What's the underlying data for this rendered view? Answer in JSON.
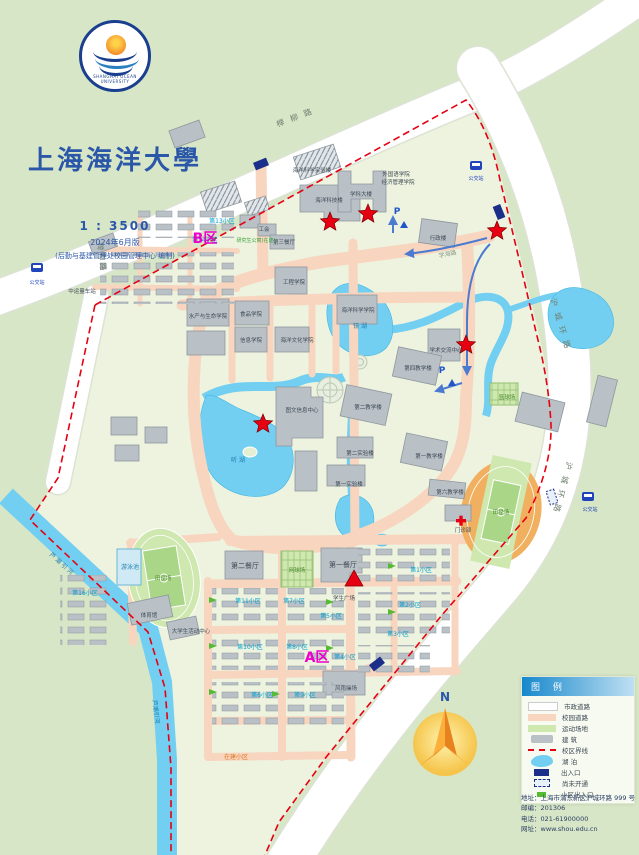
{
  "header": {
    "university_cn": "上海海洋大學",
    "university_en": "SHANGHAI OCEAN UNIVERSITY",
    "scale": "1 : 3500",
    "edition": "2024年6月版",
    "credit": "(后勤与基建管理处校园管理中心 编制)"
  },
  "compass": {
    "north": "N"
  },
  "legend": {
    "title": "图 例",
    "items": [
      {
        "label": "市政道路",
        "type": "road-city"
      },
      {
        "label": "校园道路",
        "type": "road-campus"
      },
      {
        "label": "运动场地",
        "type": "sports"
      },
      {
        "label": "建  筑",
        "type": "building"
      },
      {
        "label": "校区界线",
        "type": "boundary"
      },
      {
        "label": "湖  泊",
        "type": "lake"
      },
      {
        "label": "出入口",
        "type": "gate"
      },
      {
        "label": "尚未开通",
        "type": "gate-closed"
      },
      {
        "label": "小区出入口",
        "type": "community-gate"
      }
    ],
    "contact": [
      "地址：上海市浦东新区沪城环路 999 号",
      "邮编：201306",
      "电话：021-61900000",
      "网址：www.shou.edu.cn"
    ]
  },
  "map": {
    "labels": [
      {
        "text": "榉 柳 路",
        "x": 296,
        "y": 120,
        "rot": -21,
        "cls": "road"
      },
      {
        "text": "榉柳路",
        "x": 99,
        "y": 258,
        "rot": 82,
        "cls": "road"
      },
      {
        "text": "沪 城 环 路",
        "x": 558,
        "y": 325,
        "rot": 73,
        "cls": "road"
      },
      {
        "text": "沪 城 环 路",
        "x": 560,
        "y": 487,
        "rot": 105,
        "cls": "road"
      },
      {
        "text": "芦 潮 引 河",
        "x": 60,
        "y": 565,
        "rot": 42,
        "cls": "water"
      },
      {
        "text": "芦潮引河",
        "x": 154,
        "y": 712,
        "rot": 83,
        "cls": "water"
      },
      {
        "text": "镜 湖",
        "x": 360,
        "y": 328,
        "cls": "water"
      },
      {
        "text": "听 湖",
        "x": 238,
        "y": 462,
        "cls": "water"
      },
      {
        "text": "游泳池",
        "x": 130,
        "y": 569,
        "cls": "water"
      },
      {
        "text": "学海路",
        "x": 448,
        "y": 256,
        "rot": -12,
        "cls": "croad"
      },
      {
        "text": "海洋科技楼",
        "x": 329,
        "y": 202,
        "cls": "blds"
      },
      {
        "text": "学科大楼",
        "x": 361,
        "y": 196,
        "cls": "blds"
      },
      {
        "text": "外国语学院",
        "x": 396,
        "y": 176,
        "cls": "blds"
      },
      {
        "text": "经济管理学院",
        "x": 398,
        "y": 184,
        "cls": "blds"
      },
      {
        "text": "行政楼",
        "x": 438,
        "y": 240,
        "cls": "blds"
      },
      {
        "text": "工会",
        "x": 264,
        "y": 231,
        "cls": "blds"
      },
      {
        "text": "第三餐厅",
        "x": 284,
        "y": 244,
        "cls": "blds"
      },
      {
        "text": "海洋科学实验楼",
        "x": 312,
        "y": 172,
        "cls": "blds"
      },
      {
        "text": "水产与生命学院",
        "x": 208,
        "y": 318,
        "cls": "blds"
      },
      {
        "text": "食品学院",
        "x": 251,
        "y": 316,
        "cls": "blds"
      },
      {
        "text": "工程学院",
        "x": 294,
        "y": 284,
        "cls": "blds"
      },
      {
        "text": "海洋科学学院",
        "x": 358,
        "y": 312,
        "cls": "blds"
      },
      {
        "text": "信息学院",
        "x": 251,
        "y": 342,
        "cls": "blds"
      },
      {
        "text": "海洋文化学院",
        "x": 297,
        "y": 342,
        "cls": "blds"
      },
      {
        "text": "图文信息中心",
        "x": 302,
        "y": 412,
        "cls": "blds"
      },
      {
        "text": "学术交流中心",
        "x": 446,
        "y": 352,
        "cls": "blds"
      },
      {
        "text": "第四教学楼",
        "x": 418,
        "y": 370,
        "cls": "blds"
      },
      {
        "text": "第二教学楼",
        "x": 368,
        "y": 409,
        "cls": "blds"
      },
      {
        "text": "第一教学楼",
        "x": 429,
        "y": 458,
        "cls": "blds"
      },
      {
        "text": "第二实验楼",
        "x": 360,
        "y": 455,
        "cls": "blds"
      },
      {
        "text": "第一实验楼",
        "x": 349,
        "y": 486,
        "cls": "blds"
      },
      {
        "text": "第一餐厅",
        "x": 343,
        "y": 567,
        "cls": "bld"
      },
      {
        "text": "第二餐厅",
        "x": 245,
        "y": 568,
        "cls": "bld"
      },
      {
        "text": "学生广场",
        "x": 344,
        "y": 600,
        "cls": "blds"
      },
      {
        "text": "体育馆",
        "x": 149,
        "y": 617,
        "cls": "blds"
      },
      {
        "text": "大学生活动中心",
        "x": 191,
        "y": 633,
        "cls": "blds"
      },
      {
        "text": "风雨操场",
        "x": 346,
        "y": 690,
        "cls": "blds"
      },
      {
        "text": "门诊部",
        "x": 463,
        "y": 532,
        "cls": "blds"
      },
      {
        "text": "第六教学楼",
        "x": 450,
        "y": 494,
        "cls": "blds"
      },
      {
        "text": "中运量车站",
        "x": 82,
        "y": 293,
        "cls": "blds"
      },
      {
        "text": "田径场",
        "x": 163,
        "y": 580,
        "cls": "field"
      },
      {
        "text": "田径场",
        "x": 501,
        "y": 514,
        "cls": "field"
      },
      {
        "text": "网球场",
        "x": 297,
        "y": 572,
        "cls": "field"
      },
      {
        "text": "篮球场",
        "x": 507,
        "y": 399,
        "cls": "field"
      },
      {
        "text": "第13小区",
        "x": 222,
        "y": 223,
        "cls": "cyan"
      },
      {
        "text": "第14小区",
        "x": 205,
        "y": 242,
        "cls": "cyan"
      },
      {
        "text": "研究生公寓(在建)",
        "x": 256,
        "y": 242,
        "cls": "noteg"
      },
      {
        "text": "第16小区",
        "x": 85,
        "y": 595,
        "cls": "cyan"
      },
      {
        "text": "第11小区",
        "x": 248,
        "y": 603,
        "cls": "cyan"
      },
      {
        "text": "第7小区",
        "x": 294,
        "y": 603,
        "cls": "cyan"
      },
      {
        "text": "第10小区",
        "x": 250,
        "y": 649,
        "cls": "cyan"
      },
      {
        "text": "第8小区",
        "x": 297,
        "y": 649,
        "cls": "cyan"
      },
      {
        "text": "第5小区",
        "x": 331,
        "y": 618,
        "cls": "cyan"
      },
      {
        "text": "第4小区",
        "x": 345,
        "y": 659,
        "cls": "cyan"
      },
      {
        "text": "第6小区",
        "x": 262,
        "y": 697,
        "cls": "cyan"
      },
      {
        "text": "第9小区",
        "x": 305,
        "y": 697,
        "cls": "cyan"
      },
      {
        "text": "第1小区",
        "x": 421,
        "y": 572,
        "cls": "cyan"
      },
      {
        "text": "第2小区",
        "x": 410,
        "y": 607,
        "cls": "cyan"
      },
      {
        "text": "第3小区",
        "x": 398,
        "y": 636,
        "cls": "cyan"
      },
      {
        "text": "在建小区",
        "x": 236,
        "y": 759,
        "cls": "noteo"
      },
      {
        "text": "公交站",
        "x": 37,
        "y": 284,
        "cls": "busl"
      },
      {
        "text": "公交站",
        "x": 476,
        "y": 180,
        "cls": "busl"
      },
      {
        "text": "公交站",
        "x": 590,
        "y": 511,
        "cls": "busl"
      },
      {
        "text": "B区",
        "x": 205,
        "y": 243,
        "cls": "zone"
      },
      {
        "text": "A区",
        "x": 317,
        "y": 662,
        "cls": "zone"
      },
      {
        "text": "P",
        "x": 397,
        "y": 214,
        "cls": "plbl"
      },
      {
        "text": "P",
        "x": 442,
        "y": 373,
        "cls": "plbl"
      }
    ],
    "stars": [
      [
        330,
        222
      ],
      [
        368,
        214
      ],
      [
        497,
        231
      ],
      [
        466,
        345
      ],
      [
        263,
        424
      ]
    ],
    "triangle": [
      354,
      580
    ],
    "gates": [
      {
        "x": 261,
        "y": 164,
        "rot": -22
      },
      {
        "x": 499,
        "y": 212,
        "rot": 68
      },
      {
        "x": 377,
        "y": 664,
        "rot": -38
      }
    ],
    "gates_planned": [
      {
        "x": 552,
        "y": 497,
        "rot": 72
      }
    ],
    "bus_stops": [
      [
        37,
        267
      ],
      [
        476,
        165
      ],
      [
        588,
        496
      ]
    ],
    "flags": [
      [
        404,
        221
      ],
      [
        452,
        379
      ]
    ],
    "community_gates": [
      [
        213,
        600
      ],
      [
        213,
        646
      ],
      [
        213,
        692
      ],
      [
        330,
        602
      ],
      [
        330,
        648
      ],
      [
        392,
        566
      ],
      [
        392,
        612
      ],
      [
        276,
        694
      ]
    ]
  }
}
